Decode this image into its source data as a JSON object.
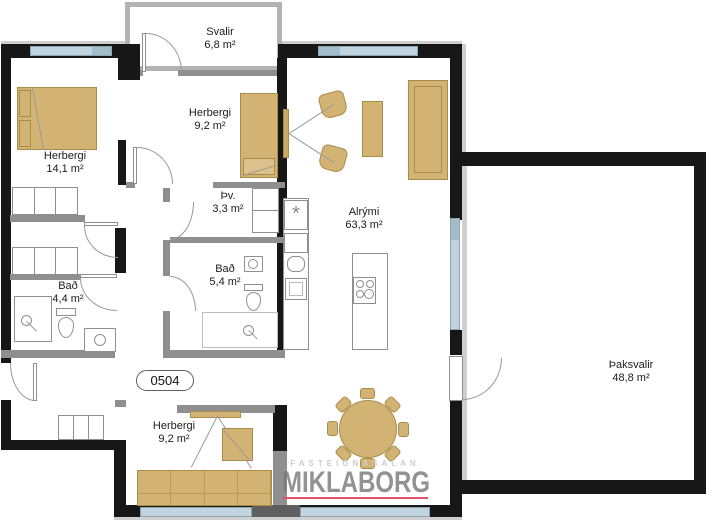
{
  "rooms": {
    "svalir": {
      "name": "Svalir",
      "area": "6,8 m²"
    },
    "herbergi_nw": {
      "name": "Herbergi",
      "area": "14,1 m²"
    },
    "herbergi_n": {
      "name": "Herbergi",
      "area": "9,2 m²"
    },
    "thvottahus": {
      "name": "Þv.",
      "area": "3,3 m²"
    },
    "bad_mid": {
      "name": "Bað",
      "area": "5,4 m²"
    },
    "bad_w": {
      "name": "Bað",
      "area": "4,4 m²"
    },
    "alrymi": {
      "name": "Alrými",
      "area": "63,3 m²"
    },
    "thaksvalir": {
      "name": "Þaksvalir",
      "area": "48,8 m²"
    },
    "herbergi_s": {
      "name": "Herbergi",
      "area": "9,2 m²"
    }
  },
  "unit": {
    "label": "0504"
  },
  "watermark": {
    "agency": "FASTEIGNASALAN",
    "brand": "MIKLABORG"
  },
  "symbols": {
    "appliance": "*"
  },
  "colors": {
    "furn": "#d3b374",
    "wall": "#171717",
    "window": "#bfd4de",
    "red": "#e4556a"
  }
}
